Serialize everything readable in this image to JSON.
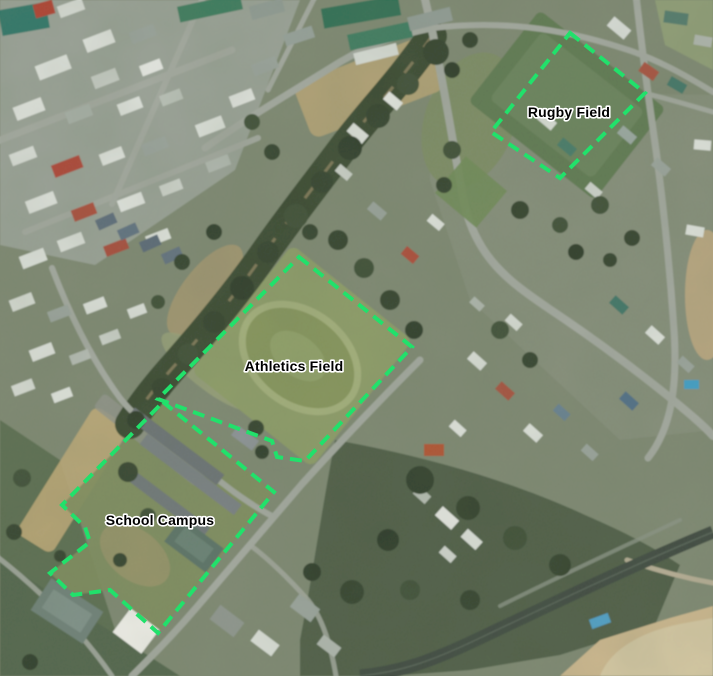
{
  "features": [
    {
      "id": "rugby-field",
      "points": "570,33 645,93 560,178 491,132",
      "label": {
        "text": "Rugby Field",
        "x": 569,
        "y": 117
      }
    },
    {
      "id": "athletics-field",
      "points": "299,257 412,347 305,461 277,457 272,441 158,399",
      "label": {
        "text": "Athletics Field",
        "x": 294,
        "y": 371
      }
    },
    {
      "id": "school-campus",
      "points": "163,402 274,492 158,633 110,590 73,595 50,573 90,542 85,527 62,505",
      "label": {
        "text": "School Campus",
        "x": 160,
        "y": 525
      }
    }
  ],
  "style": {
    "outline_color": "#21e16b",
    "outline_width": 4,
    "dash_pattern": "12 7",
    "label_color": "#000000",
    "label_halo_color": "#ffffff"
  }
}
